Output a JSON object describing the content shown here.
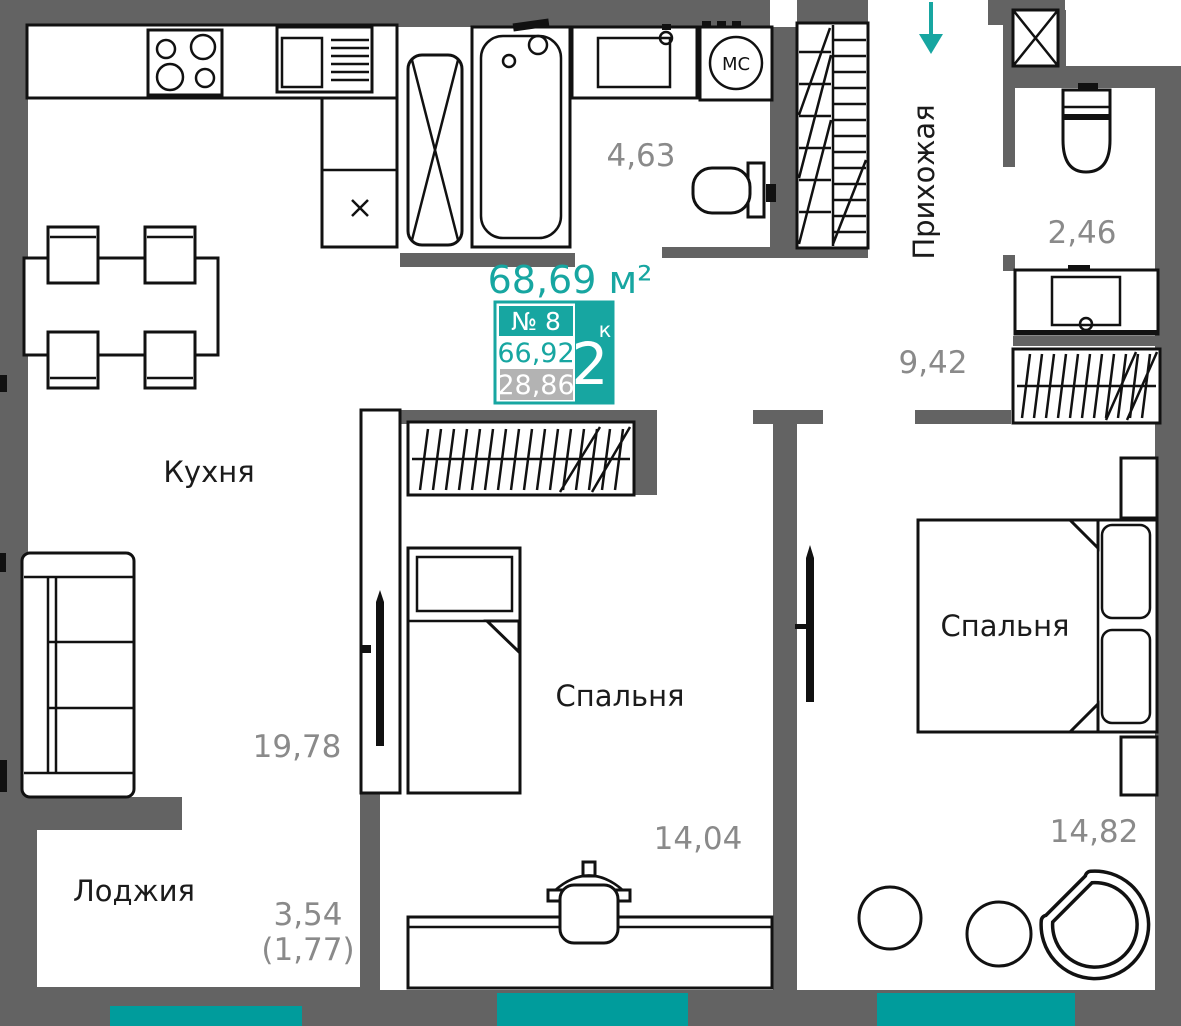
{
  "meta": {
    "plan_type": "apartment-floor-plan",
    "title_area": "68,69 м²"
  },
  "badge": {
    "number": "№ 8",
    "area_total": "66,92",
    "area_living": "28,86",
    "rooms_count": "2",
    "rooms_unit": "к"
  },
  "rooms": {
    "kitchen": {
      "label": "Кухня",
      "area": "19,78"
    },
    "bathroom": {
      "area": "4,63"
    },
    "hallway": {
      "label": "Прихожая",
      "area": "9,42"
    },
    "wc": {
      "area": "2,46"
    },
    "bedroom_middle": {
      "label": "Спальня",
      "area": "14,04"
    },
    "bedroom_right": {
      "label": "Спальня",
      "area": "14,82"
    },
    "loggia": {
      "label": "Лоджия",
      "area": "3,54",
      "area_secondary": "(1,77)"
    }
  },
  "appliances": {
    "washing_machine": "МС"
  },
  "colors": {
    "wall": "#636363",
    "accent": "#17A6A1",
    "window": "#009C9C",
    "badge_gray": "#B3B3B3",
    "area_text": "#8A8A8A"
  }
}
